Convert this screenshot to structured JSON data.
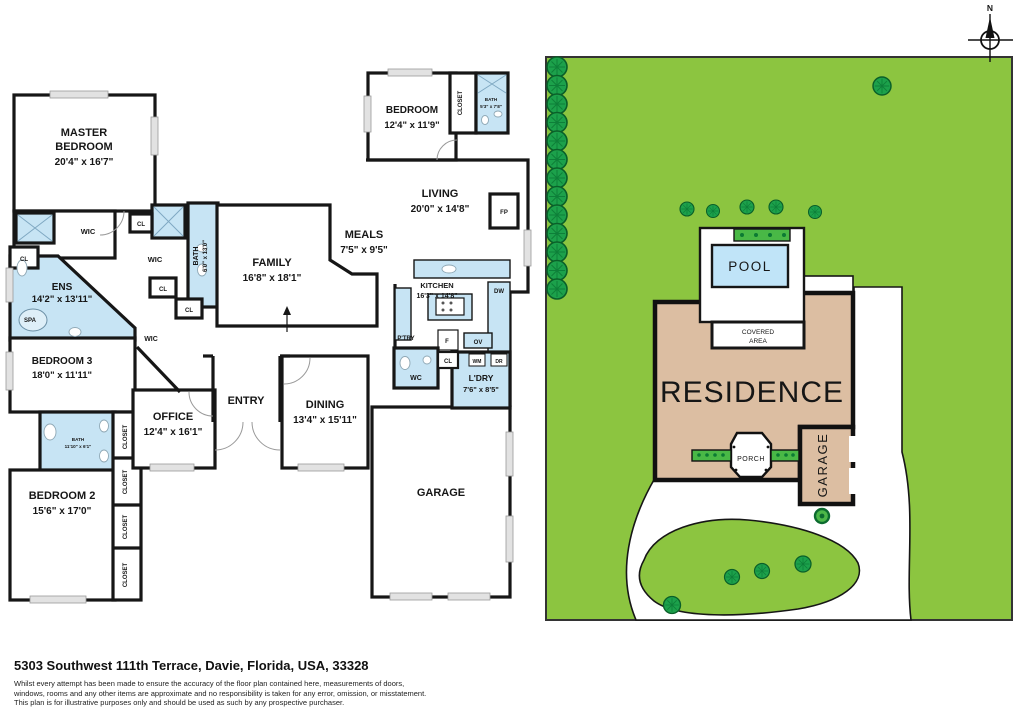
{
  "floorplan": {
    "rooms": {
      "master": {
        "name1": "MASTER",
        "name2": "BEDROOM",
        "dims": "20'4\" x 16'7\""
      },
      "bedtop": {
        "name": "BEDROOM",
        "dims": "12'4\" x 11'9\""
      },
      "living": {
        "name": "LIVING",
        "dims": "20'0\" x 14'8\""
      },
      "meals": {
        "name": "MEALS",
        "dims": "7'5\" x 9'5\""
      },
      "family": {
        "name": "FAMILY",
        "dims": "16'8\" x 18'1\""
      },
      "ens": {
        "name": "ENS",
        "dims": "14'2\" x 13'11\""
      },
      "bed3": {
        "name": "BEDROOM 3",
        "dims": "18'0\" x 11'11\""
      },
      "office": {
        "name": "OFFICE",
        "dims": "12'4\" x 16'1\""
      },
      "entry": {
        "name": "ENTRY"
      },
      "dining": {
        "name": "DINING",
        "dims": "13'4\" x 15'11\""
      },
      "kitchen": {
        "name": "KITCHEN",
        "dims": "16'3\" x 14'8\""
      },
      "bed2": {
        "name": "BEDROOM 2",
        "dims": "15'6\" x 17'0\""
      },
      "garage": {
        "name": "GARAGE"
      },
      "ldry": {
        "name": "L'DRY",
        "dims": "7'6\" x 8'5\""
      },
      "bathmid": {
        "name": "BATH",
        "dims": "6'0\" x 13'0\""
      },
      "bathtop": {
        "name": "BATH",
        "dims": "5'3\" x 7'8\""
      },
      "bath2": {
        "name": "BATH",
        "dims": "11'10\" x 6'1\""
      }
    },
    "small": {
      "wic": "WIC",
      "cl": "CL",
      "spa": "SPA",
      "closet": "CLOSET",
      "fp": "FP",
      "dw": "DW",
      "ptry": "P'TRY",
      "f": "F",
      "ov": "OV",
      "wm": "WM",
      "dr": "DR",
      "wc": "WC"
    }
  },
  "siteplan": {
    "labels": {
      "pool": "POOL",
      "covered1": "COVERED",
      "covered2": "AREA",
      "residence": "RESIDENCE",
      "porch": "PORCH",
      "garage": "GARAGE",
      "north": "N"
    },
    "colors": {
      "grass": "#8CC540",
      "tree": "#1CA14B",
      "building": "#DCBEA2",
      "pool": "#C0E4F8"
    }
  },
  "footer": {
    "address": "5303 Southwest 111th Terrace, Davie, Florida, USA, 33328",
    "disclaimer1": "Whilst every attempt has been made to ensure the accuracy of the floor plan contained here, measurements of doors,",
    "disclaimer2": "windows, rooms and any other items are approximate and no responsibility is taken for any error, omission, or misstatement.",
    "disclaimer3": "This plan is for illustrative purposes only and should be used as such by any prospective purchaser."
  }
}
